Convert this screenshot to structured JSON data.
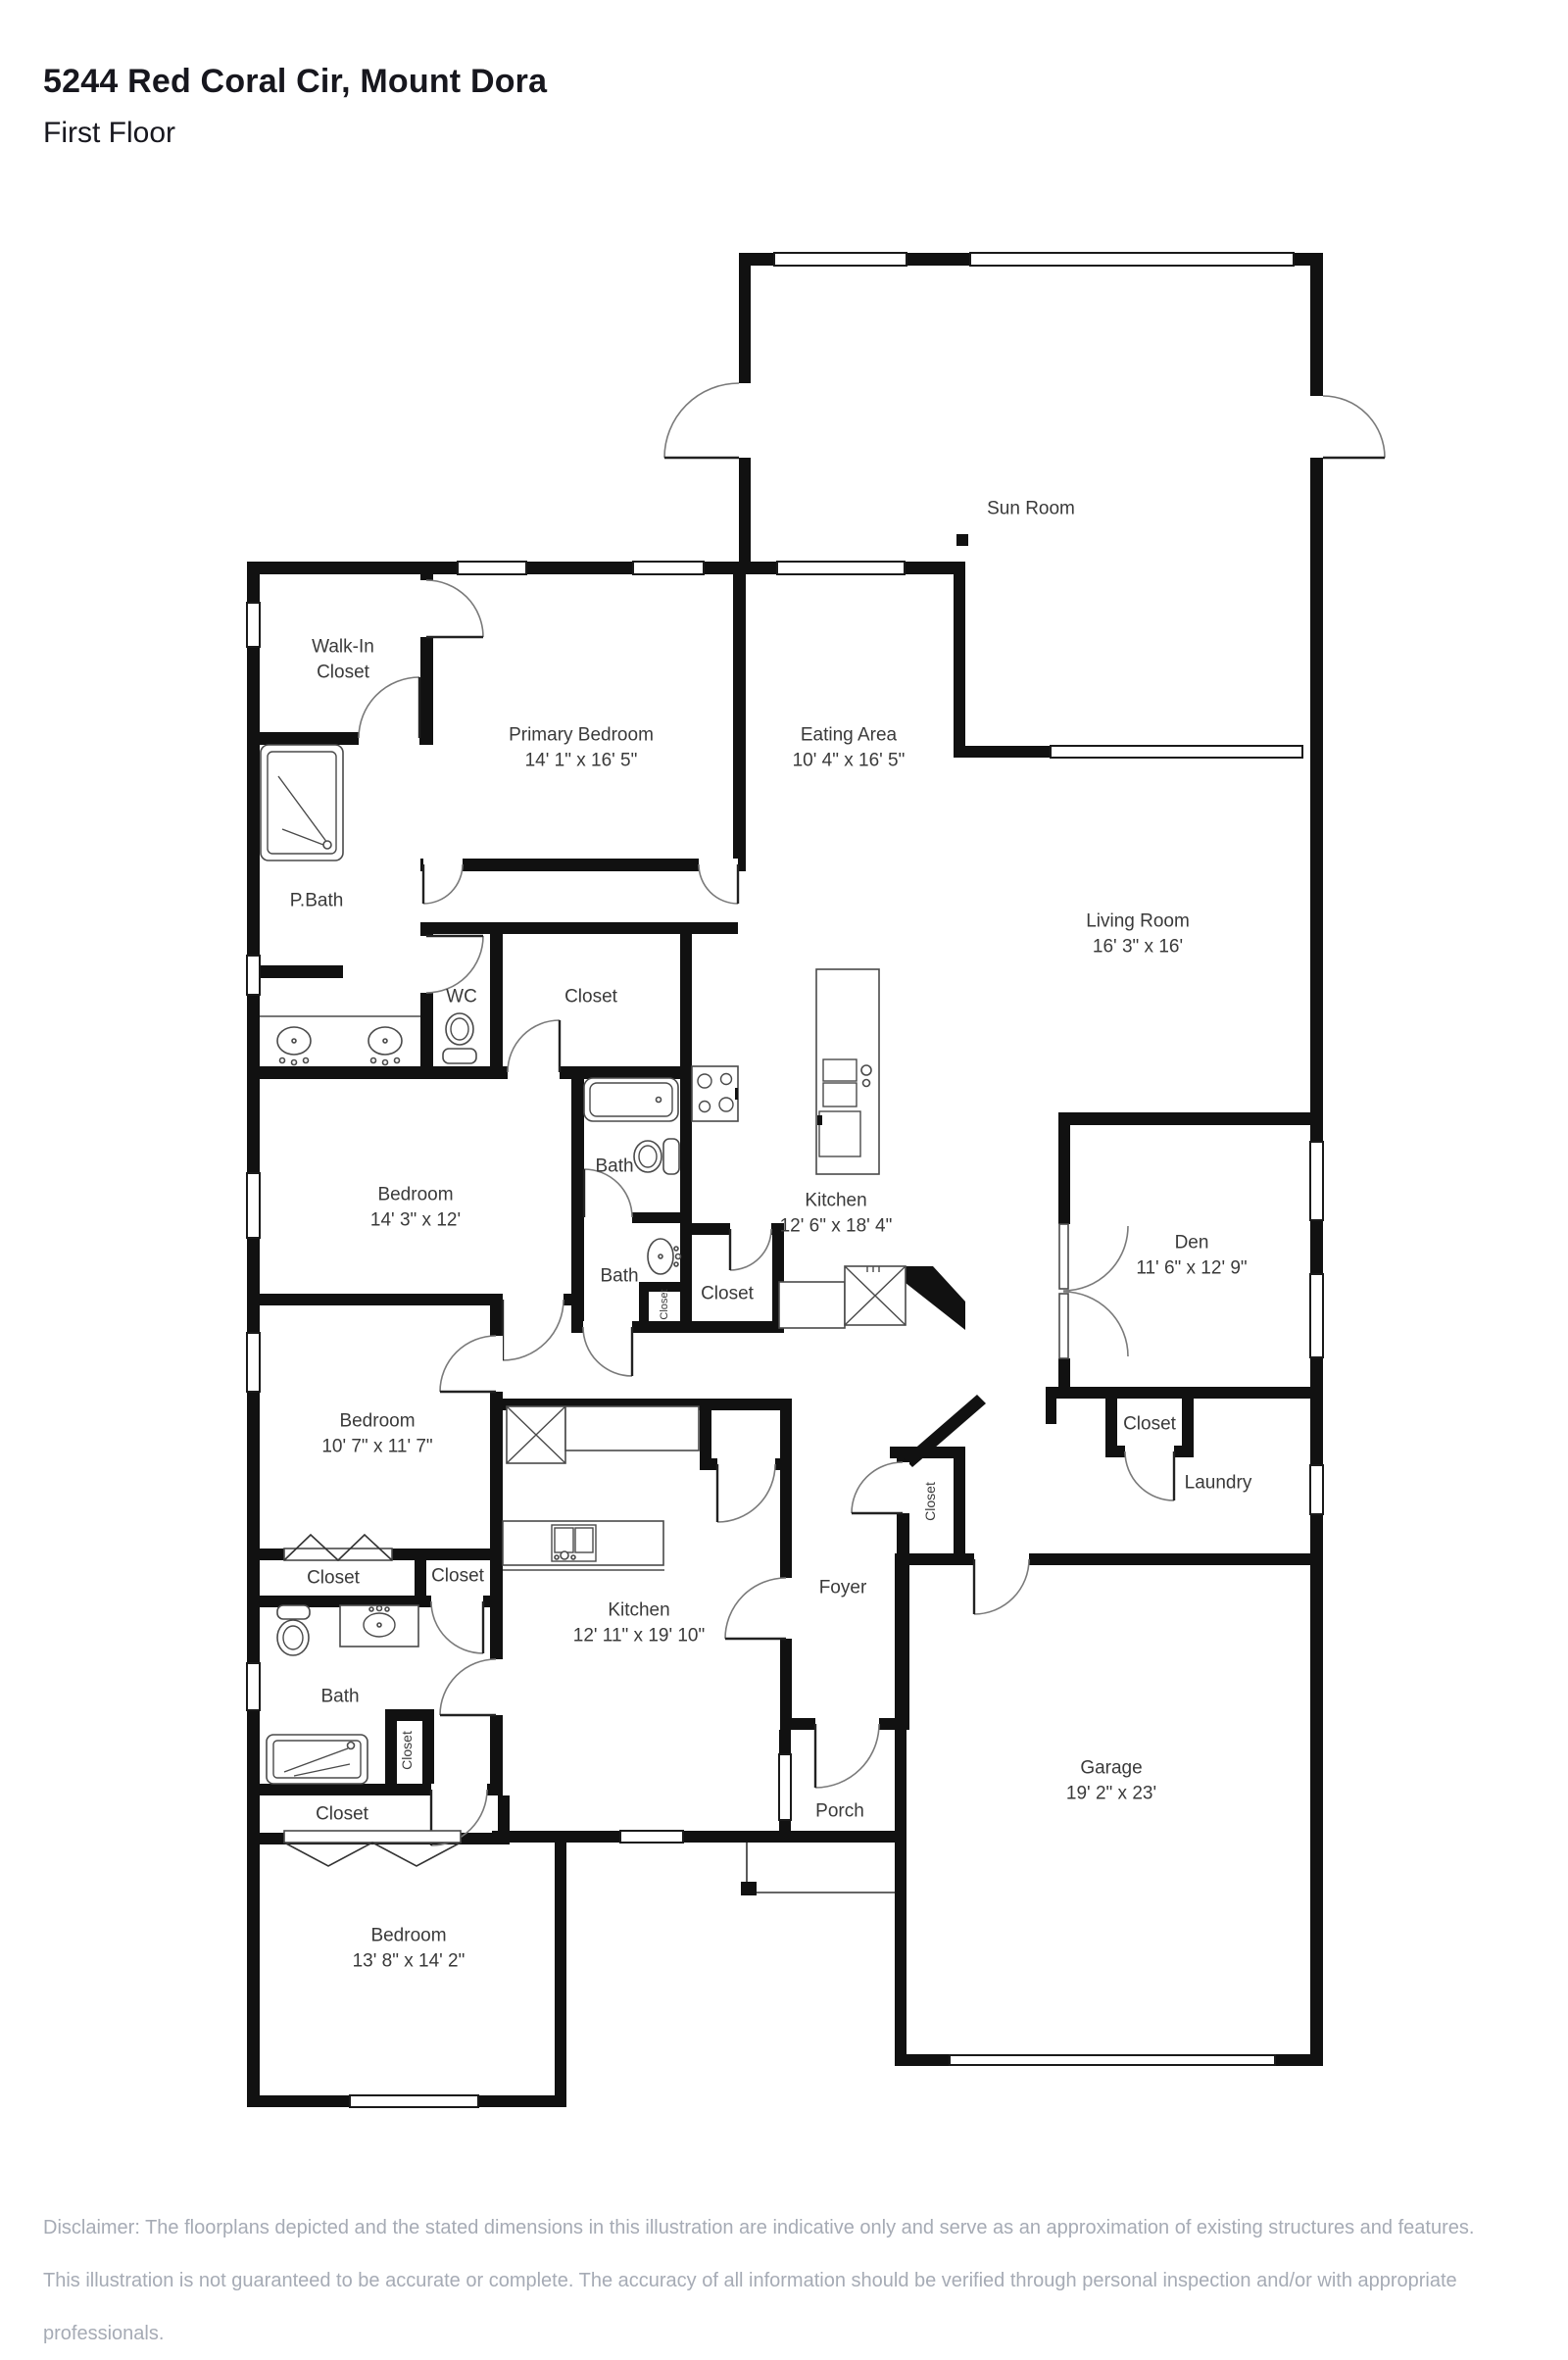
{
  "page": {
    "title": "5244 Red Coral Cir, Mount Dora",
    "subtitle": "First Floor"
  },
  "disclaimer": {
    "line1": "Disclaimer: The floorplans depicted and the stated dimensions in this illustration are indicative only and serve as an approximation of existing structures and features.",
    "line2": "This illustration is not guaranteed to be accurate or complete. The accuracy of all information should be verified through personal inspection and/or with appropriate professionals."
  },
  "colors": {
    "wall": "#111111",
    "label": "#3a3a3a",
    "fixture": "#4a4a4a",
    "disclaimer": "#a6abb5",
    "background": "#ffffff"
  },
  "rooms": {
    "sunroom": {
      "label": "Sun Room"
    },
    "walkin": {
      "line1": "Walk-In",
      "line2": "Closet"
    },
    "primary": {
      "label": "Primary Bedroom",
      "dims": "14' 1\" x 16' 5\""
    },
    "eating": {
      "label": "Eating Area",
      "dims": "10' 4\" x 16' 5\""
    },
    "living": {
      "label": "Living Room",
      "dims": "16' 3\" x 16'"
    },
    "pbath": {
      "label": "P.Bath"
    },
    "wc": {
      "label": "WC"
    },
    "closet_hall": {
      "label": "Closet"
    },
    "bedroom1": {
      "label": "Bedroom",
      "dims": "14' 3\" x 12'"
    },
    "bath1": {
      "label": "Bath"
    },
    "kitchen1": {
      "label": "Kitchen",
      "dims": "12' 6\" x 18' 4\""
    },
    "den": {
      "label": "Den",
      "dims": "11' 6\" x 12' 9\""
    },
    "bath2": {
      "label": "Bath"
    },
    "closet_a": {
      "label": "Closet"
    },
    "closet_bath2": {
      "label": "Closet"
    },
    "bedroom2": {
      "label": "Bedroom",
      "dims": "10' 7\" x 11' 7\""
    },
    "closet_den": {
      "label": "Closet"
    },
    "laundry": {
      "label": "Laundry"
    },
    "closet_d": {
      "label": "Closet"
    },
    "closet_e": {
      "label": "Closet"
    },
    "closet_c": {
      "label": "Closet"
    },
    "foyer": {
      "label": "Foyer"
    },
    "kitchen2": {
      "label": "Kitchen",
      "dims": "12' 11\" x 19' 10\""
    },
    "bath3": {
      "label": "Bath"
    },
    "closet_f": {
      "label": "Closet"
    },
    "closet_g": {
      "label": "Closet"
    },
    "porch": {
      "label": "Porch"
    },
    "garage": {
      "label": "Garage",
      "dims": "19' 2\" x 23'"
    },
    "bedroom3": {
      "label": "Bedroom",
      "dims": "13' 8\" x 14' 2\""
    }
  }
}
